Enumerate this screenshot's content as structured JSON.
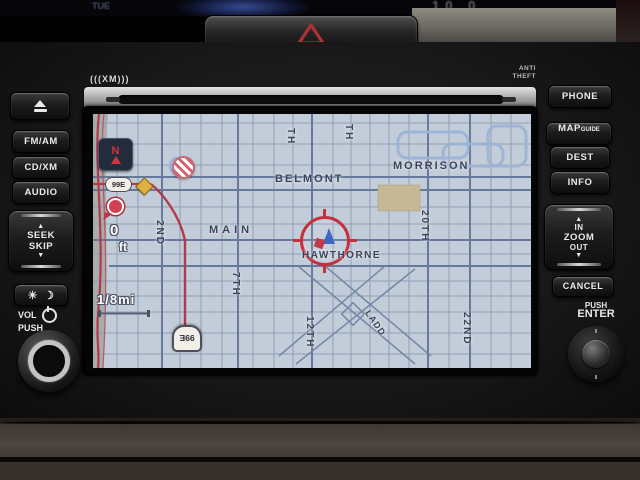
{
  "top_display": {
    "day": "TUE",
    "clock_fragment": "10 0"
  },
  "dashboard": {
    "hazard_icon": "hazard-warning-triangle"
  },
  "head_unit": {
    "xm_label": "(((XM)))",
    "anti_theft": {
      "line1": "ANTI",
      "line2": "THEFT"
    },
    "left_panel": {
      "eject_icon": "eject",
      "fm_am": "FM/AM",
      "cd_xm": "CD/XM",
      "audio": "AUDIO",
      "seek_up_icon": "▲",
      "seek_line1": "SEEK",
      "seek_line2": "SKIP",
      "seek_down_icon": "▼",
      "brightness_day_icon": "☀",
      "brightness_night_icon": "☽",
      "vol_label": "VOL",
      "vol_push_label": "PUSH",
      "power_icon": "power"
    },
    "right_panel": {
      "phone": "PHONE",
      "map_label": "MAP",
      "map_sub": "GUIDE",
      "dest": "DEST",
      "info": "INFO",
      "zoom_up_icon": "▲",
      "zoom_in": "IN",
      "zoom_label": "ZOOM",
      "zoom_out": "OUT",
      "zoom_down_icon": "▼",
      "cancel": "CANCEL",
      "enter_push_label": "PUSH",
      "enter_label": "ENTER"
    }
  },
  "nav_screen": {
    "streets": {
      "morrison": "MORRISON",
      "belmont": "BELMONT",
      "main": "MAIN",
      "hawthorne": "HAWTHORNE",
      "second": "2ND",
      "seventh": "7TH",
      "twelfth": "12TH",
      "twentieth": "20TH",
      "twenty_second": "22ND",
      "ladd": "LADD",
      "partial_th_1": "TH",
      "partial_th_2": "TH"
    },
    "compass_n": "N",
    "route_shield_upper": "99E",
    "route_shield_lower": "99E",
    "distance_value": "0",
    "distance_unit": "ft",
    "scale_label": "1/8mi",
    "colors": {
      "map_background": "#c3ccd9",
      "grid_line": "#8fa0b8",
      "major_road": "#67799a",
      "route_red": "#b5394b",
      "landmark_tan": "#c6b895",
      "cursor_red": "#c5303c",
      "river_strip": "#a6aeac"
    }
  }
}
